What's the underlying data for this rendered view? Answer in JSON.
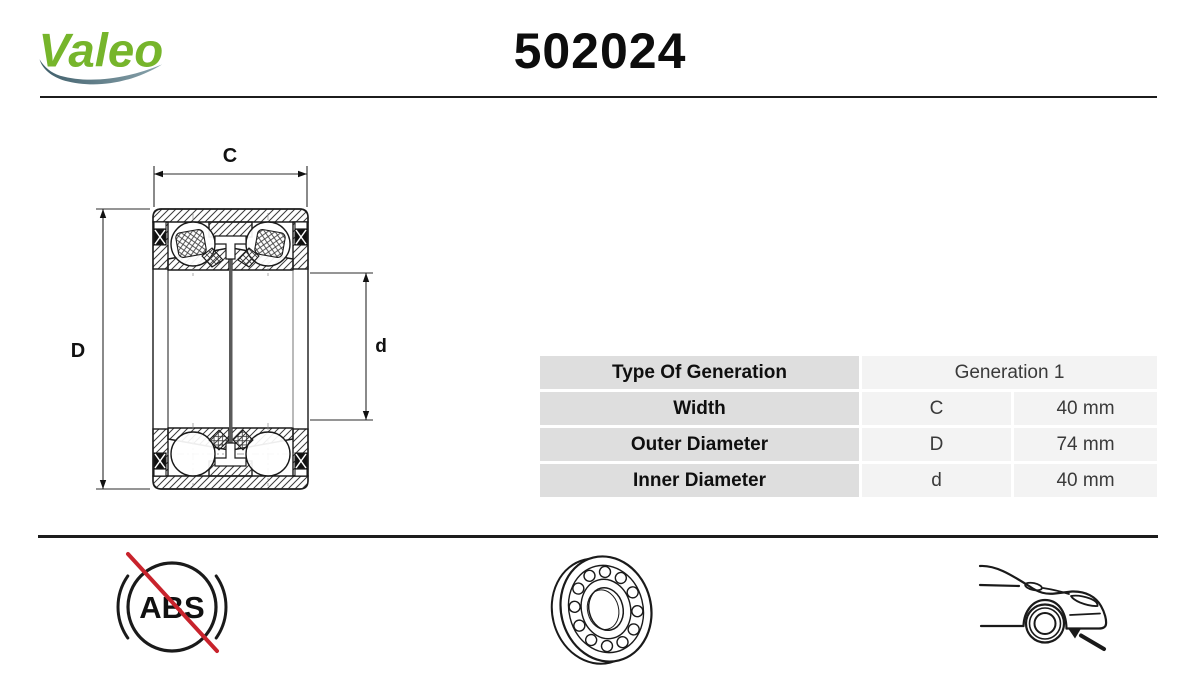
{
  "header": {
    "logo_text": "Valeo",
    "part_number": "502024"
  },
  "diagram": {
    "dim_width_label": "C",
    "dim_outer_label": "D",
    "dim_inner_label": "d"
  },
  "table": {
    "rows": [
      {
        "label": "Type Of Generation",
        "value": "Generation 1"
      },
      {
        "label": "Width",
        "symbol": "C",
        "value": "40 mm"
      },
      {
        "label": "Outer Diameter",
        "symbol": "D",
        "value": "74 mm"
      },
      {
        "label": "Inner Diameter",
        "symbol": "d",
        "value": "40 mm"
      }
    ]
  },
  "footer": {
    "abs_label": "ABS"
  },
  "colors": {
    "brand_green": "#76B52B",
    "swoosh_teal_dark": "#3F5E6A",
    "swoosh_teal_light": "#8AA4AD",
    "cross_red": "#C8232C",
    "table_label_bg": "#DEDEDE",
    "table_value_bg": "#F3F3F3",
    "line_black": "#1A1A1A"
  }
}
